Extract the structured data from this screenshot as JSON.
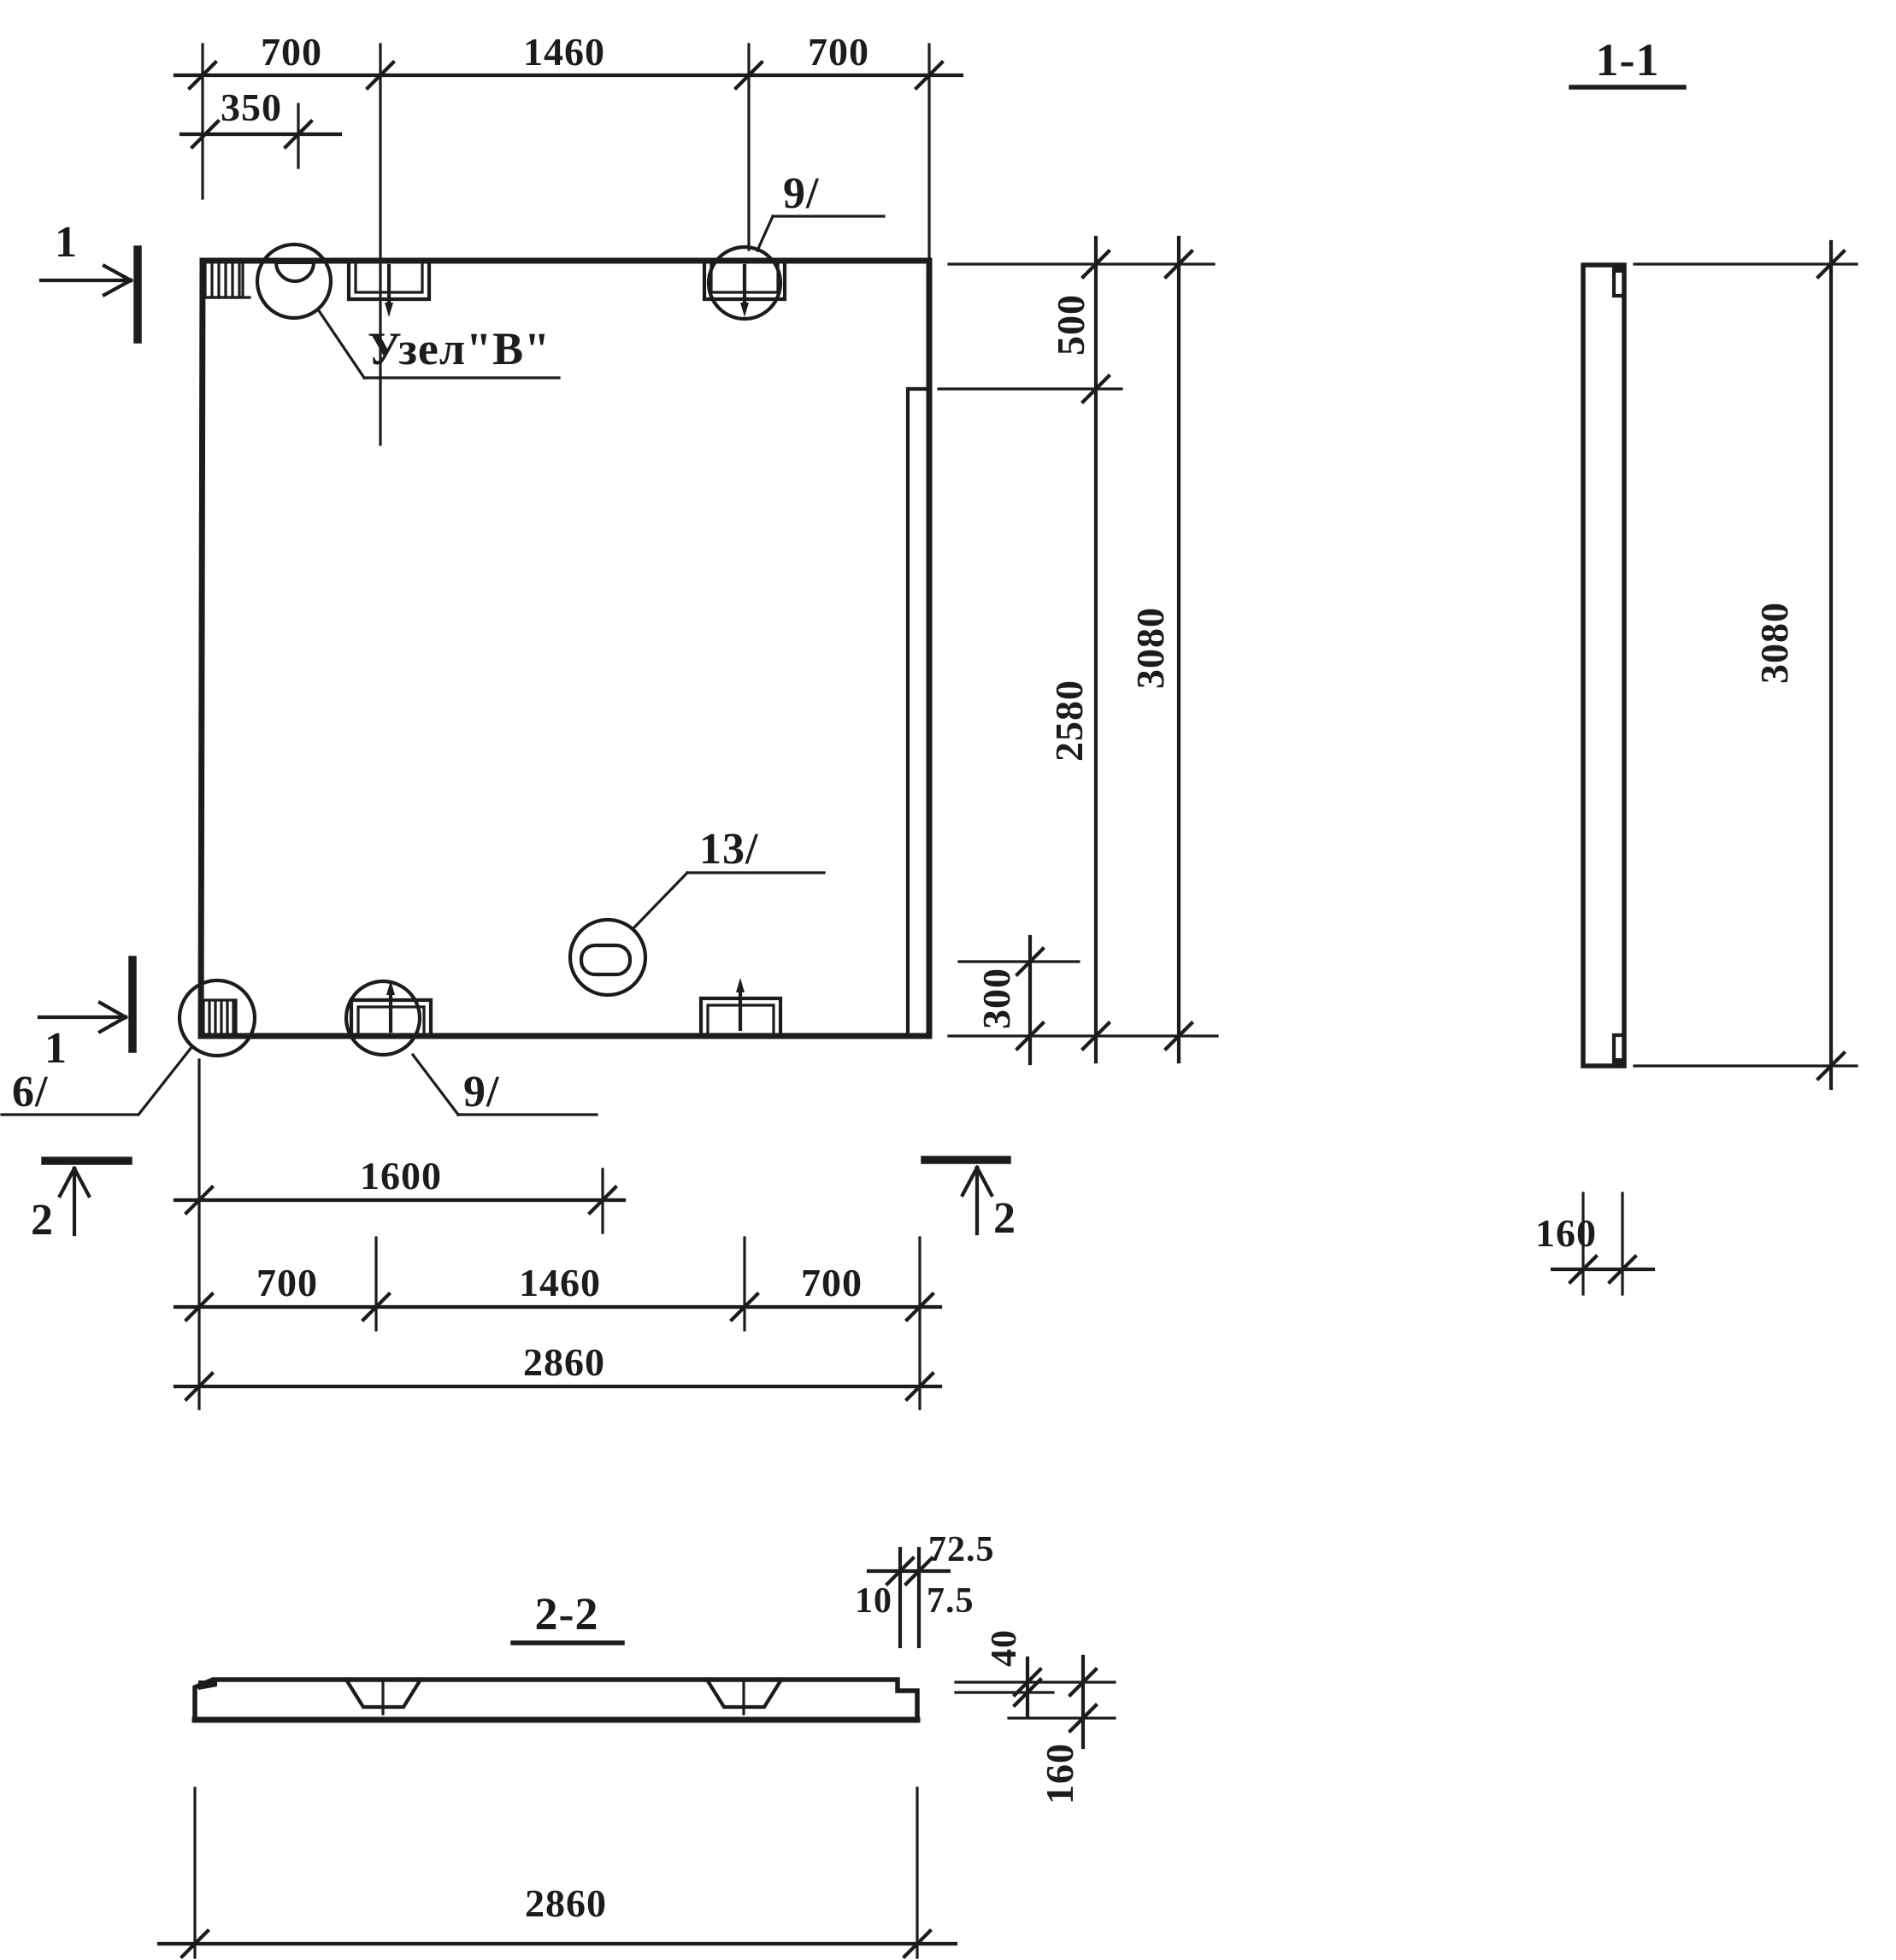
{
  "canvas": {
    "background": "#ffffff",
    "ink": "#1c1c1c"
  },
  "plan": {
    "node_label": "Узел\"В\"",
    "callout_top": "9/",
    "callout_bottom": "9/",
    "callout_corner": "6/",
    "callout_slot": "13/",
    "dim_top": [
      "700",
      "1460",
      "700"
    ],
    "dim_top_offset": "350",
    "dim_right_top": "500",
    "dim_right_mid": "2580",
    "dim_right_overall": "3080",
    "dim_right_bottom": "300",
    "dim_below_row1": "1600",
    "dim_below_row2": [
      "700",
      "1460",
      "700"
    ],
    "dim_below_overall": "2860"
  },
  "section_1_1": {
    "title": "1-1",
    "dim_height": "3080",
    "dim_thickness": "160"
  },
  "section_2_2": {
    "title": "2-2",
    "dim_width": "2860",
    "dim_notch_top": "72.5",
    "dim_gap": "10",
    "dim_lip": "7.5",
    "dim_step": "40",
    "dim_thickness": "160"
  },
  "markers": {
    "cut1": "1",
    "cut2": "2"
  }
}
